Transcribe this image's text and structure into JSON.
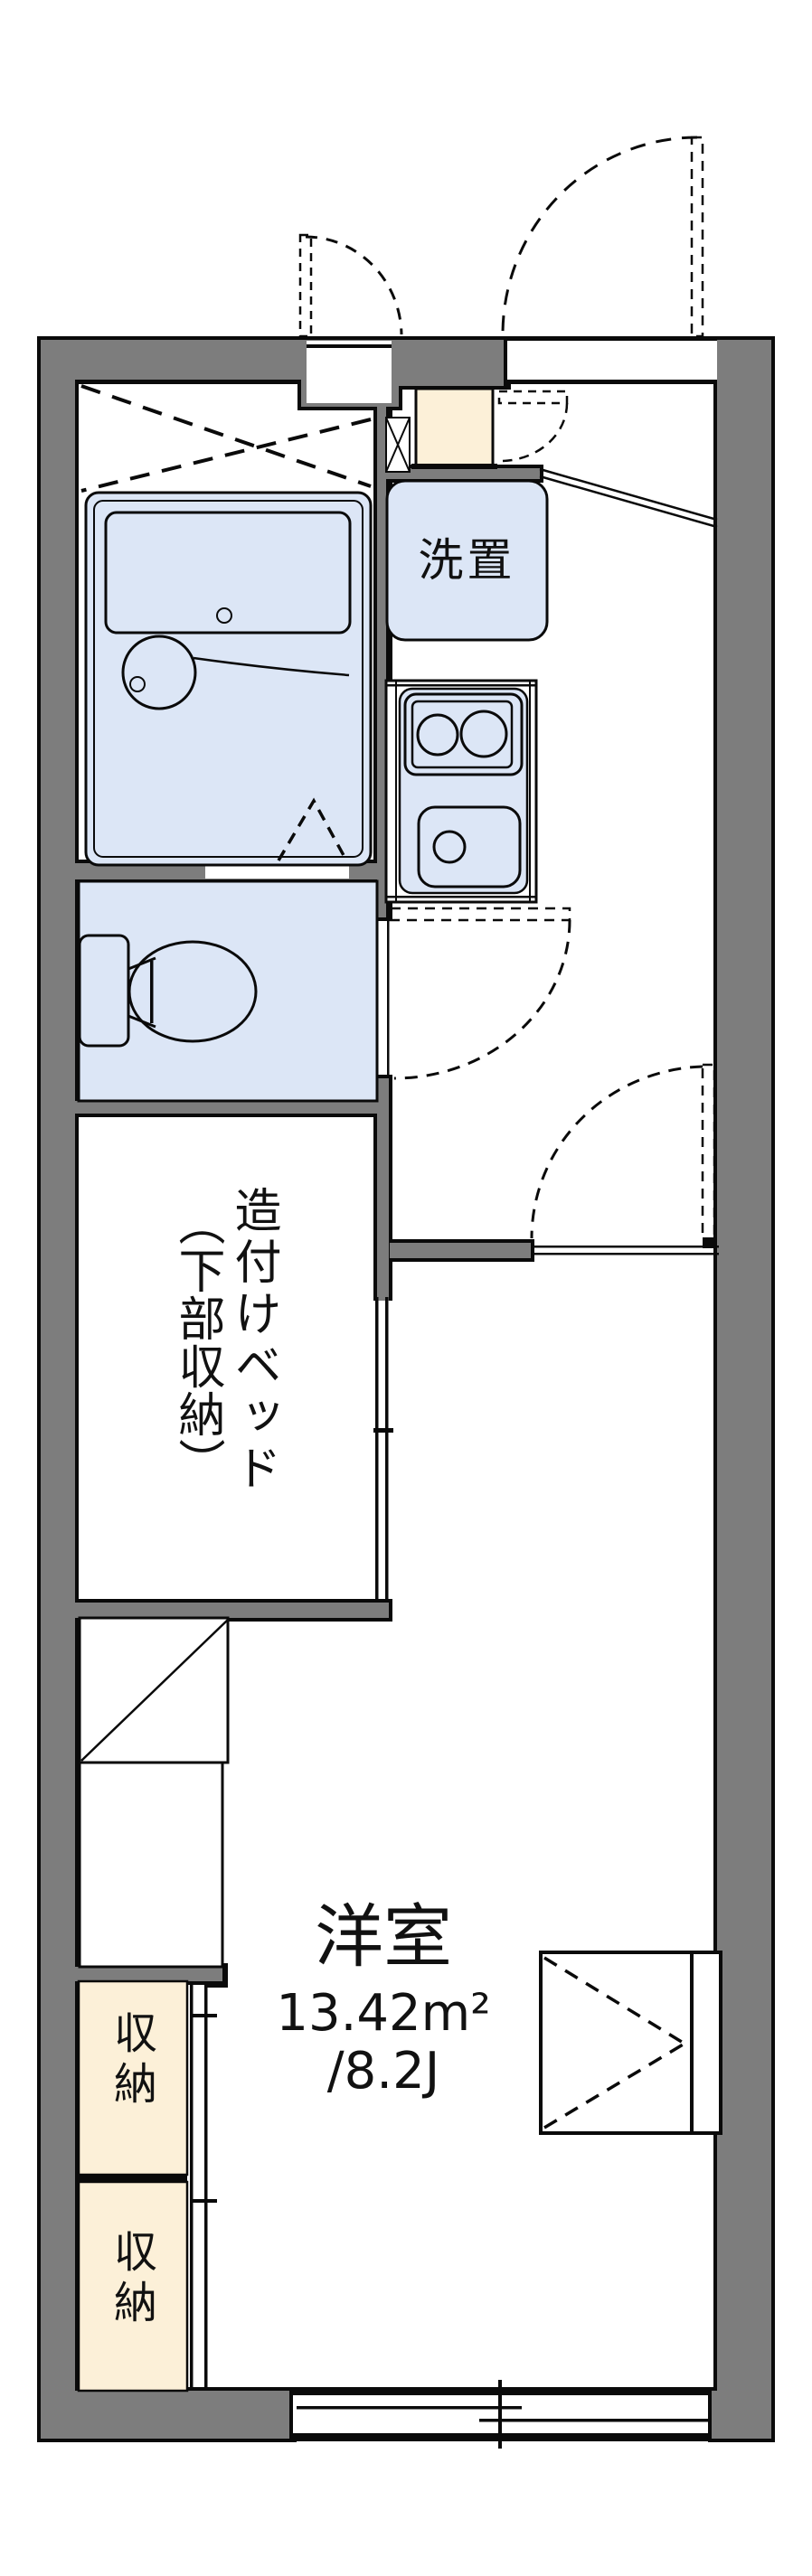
{
  "plan": {
    "type": "japanese-apartment-floorplan",
    "labels": {
      "laundry": "洗置",
      "bed_line1": "造付けベッド",
      "bed_line2": "（下部収納）",
      "room_name": "洋室",
      "room_area_sqm": "13.42m²",
      "room_area_jo": "/8.2J",
      "storage_upper": "収納",
      "storage_lower": "収納"
    },
    "colors": {
      "wall": "#7d7d7d",
      "fixture_blue": "#dce6f6",
      "storage_cream": "#fcf0d8",
      "line": "#0a0a0a",
      "floor": "#ffffff"
    },
    "icons": {
      "bathtub": "bathtub-plan-icon",
      "toilet": "toilet-plan-icon",
      "stove": "two-burner-stove-icon",
      "sink": "kitchen-sink-icon",
      "doors": "door-swing-arc-icon",
      "window": "sliding-window-icon"
    }
  }
}
